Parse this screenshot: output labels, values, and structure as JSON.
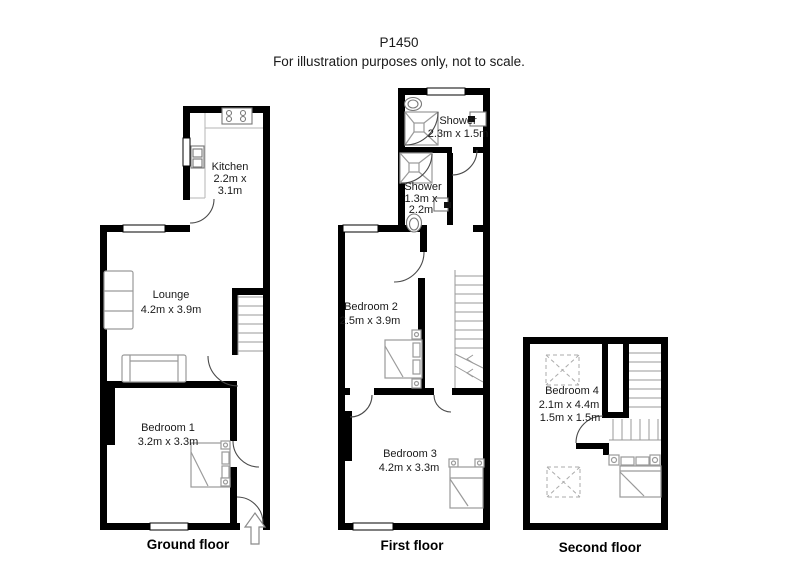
{
  "header": {
    "plan_id": "P1450",
    "disclaimer": "For illustration purposes only, not to scale."
  },
  "colors": {
    "wall": "#000000",
    "furniture_outline": "#9a9a9a",
    "door_arc": "#4a4a4a",
    "background": "#ffffff",
    "text": "#1a1a1a"
  },
  "floors": {
    "ground": {
      "label": "Ground floor",
      "rooms": {
        "kitchen": {
          "name": "Kitchen",
          "dims": "2.2m x",
          "dims2": "3.1m"
        },
        "lounge": {
          "name": "Lounge",
          "dims": "4.2m x 3.9m"
        },
        "bedroom1": {
          "name": "Bedroom 1",
          "dims": "3.2m x 3.3m"
        }
      }
    },
    "first": {
      "label": "First floor",
      "rooms": {
        "shower_top": {
          "name": "Shower",
          "dims": "2.3m x 1.5m"
        },
        "shower_mid": {
          "name": "Shower",
          "dims": "1.3m x",
          "dims2": "2.2m"
        },
        "bedroom2": {
          "name": "Bedroom 2",
          "dims": "2.5m x 3.9m"
        },
        "bedroom3": {
          "name": "Bedroom 3",
          "dims": "4.2m x 3.3m"
        }
      }
    },
    "second": {
      "label": "Second floor",
      "rooms": {
        "bedroom4": {
          "name": "Bedroom 4",
          "dims": "2.1m x 4.4m",
          "dims2": "1.5m x 1.5m"
        }
      }
    }
  }
}
